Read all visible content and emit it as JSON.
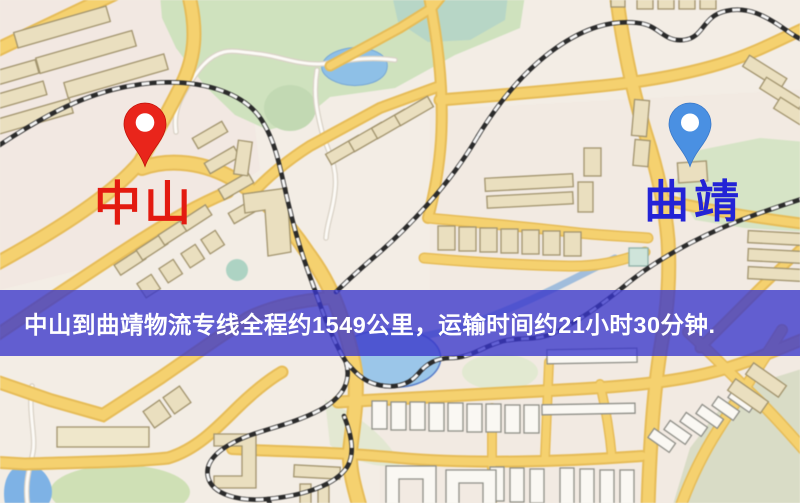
{
  "banner": {
    "text": "中山到曲靖物流专线全程约1549公里，运输时间约21小时30分钟.",
    "distance_text": "1549公里",
    "duration_text": "21小时30分钟",
    "bg_color": "#3836ca",
    "text_color": "#ffffff"
  },
  "pins": {
    "origin": {
      "label": "中山",
      "pin_color": "#e9251b",
      "label_color": "#e31a10"
    },
    "destination": {
      "label": "曲靖",
      "pin_color": "#4a90e2",
      "label_color": "#2323d6"
    }
  },
  "map_palette": {
    "base": "#f3ede5",
    "road_fill": "#f4d171",
    "road_casing": "#e5bc5a",
    "minor_road": "#fcfaf6",
    "park_green": "#cfe2bf",
    "water_blue": "#8fc0e6",
    "building_tan": "#eadfc0",
    "building_white": "#faf8f3",
    "railway": "#2b2b2b"
  }
}
